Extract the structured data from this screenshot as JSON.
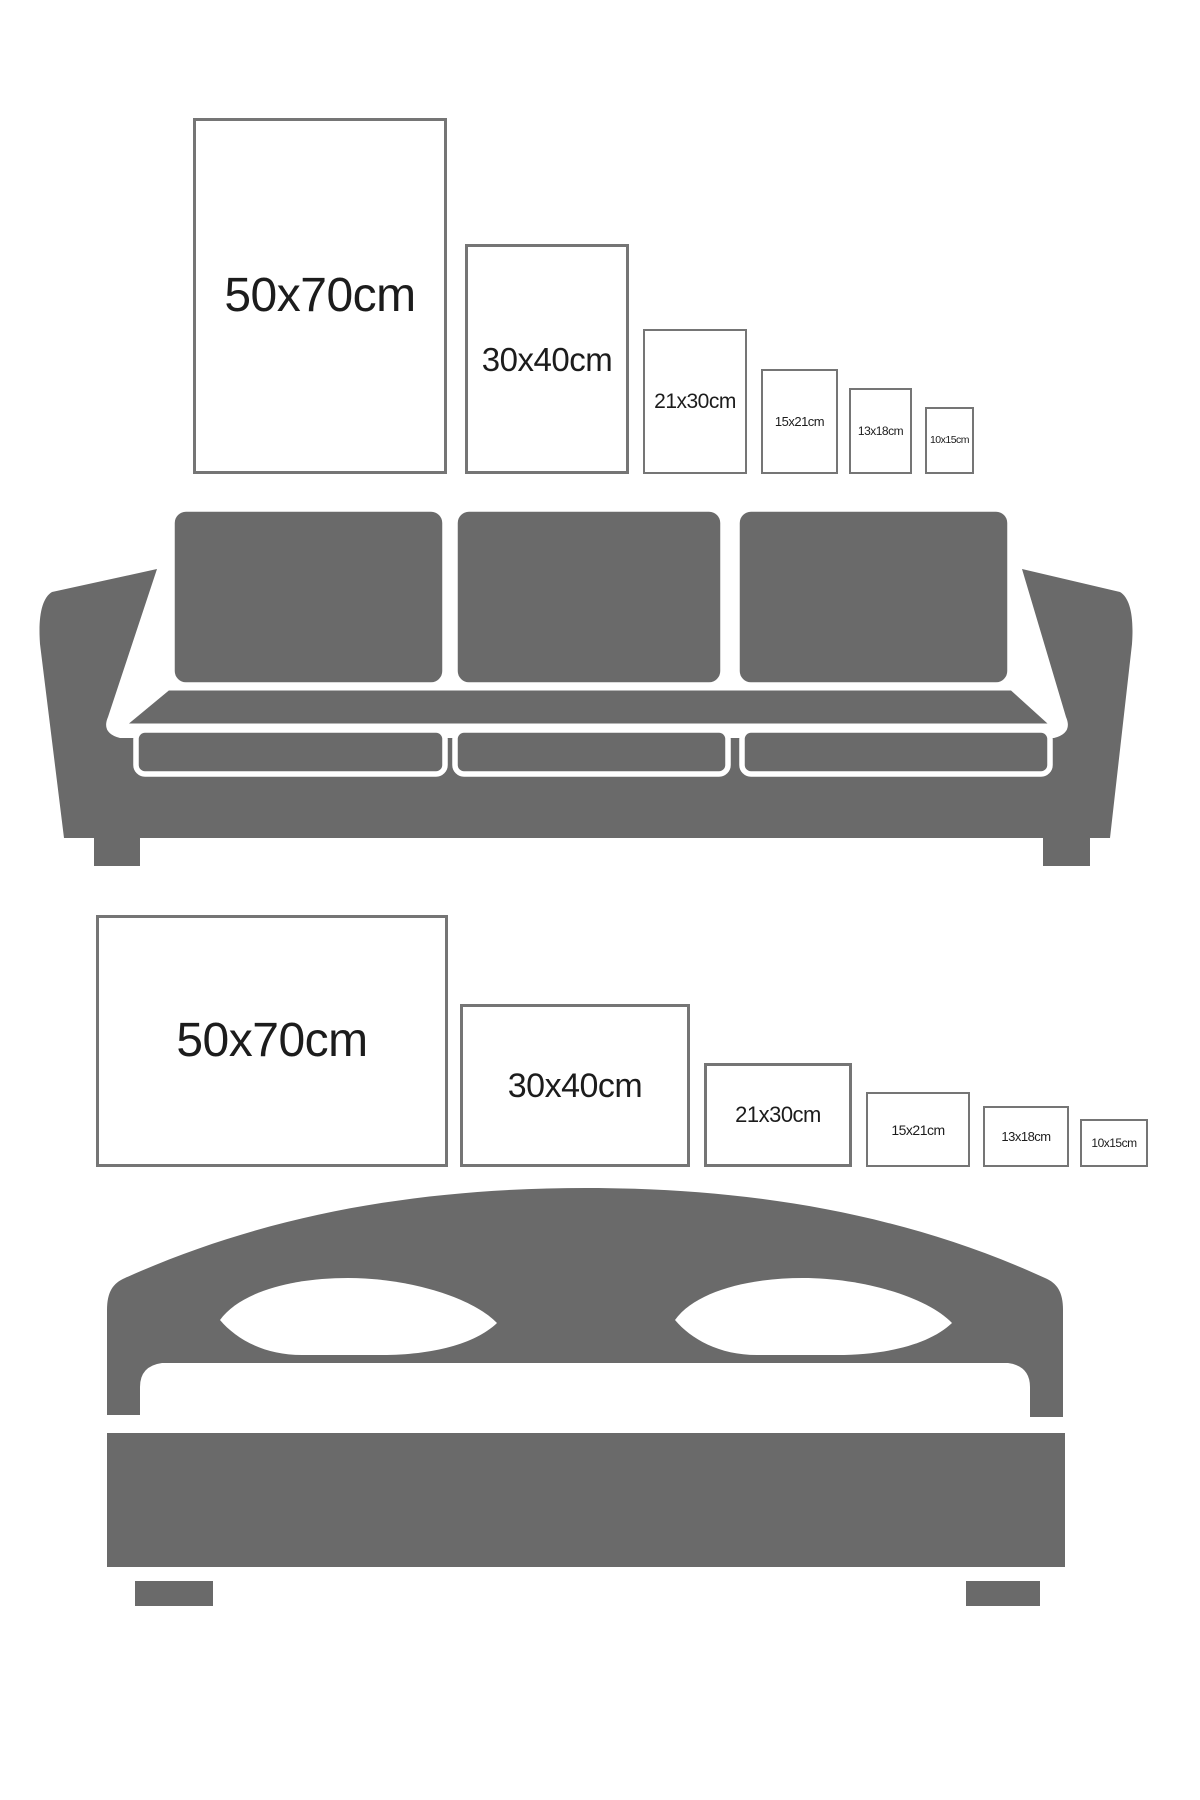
{
  "page": {
    "background": "#ffffff",
    "description_visible_text_only": true
  },
  "colors": {
    "furniture_gray": "#6a6a6a",
    "frame_border": "#757575",
    "label_text": "#1c1c1c",
    "cutout_white": "#ffffff"
  },
  "top_section": {
    "orientation": "portrait",
    "frames": [
      {
        "label": "50x70cm"
      },
      {
        "label": "30x40cm"
      },
      {
        "label": "21x30cm"
      },
      {
        "label": "15x21cm"
      },
      {
        "label": "13x18cm"
      },
      {
        "label": "10x15cm"
      }
    ]
  },
  "bottom_section": {
    "orientation": "landscape",
    "frames": [
      {
        "label": "50x70cm"
      },
      {
        "label": "30x40cm"
      },
      {
        "label": "21x30cm"
      },
      {
        "label": "15x21cm"
      },
      {
        "label": "13x18cm"
      },
      {
        "label": "10x15cm"
      }
    ]
  },
  "icons": {
    "sofa": "sofa-illustration",
    "bed": "bed-illustration"
  }
}
